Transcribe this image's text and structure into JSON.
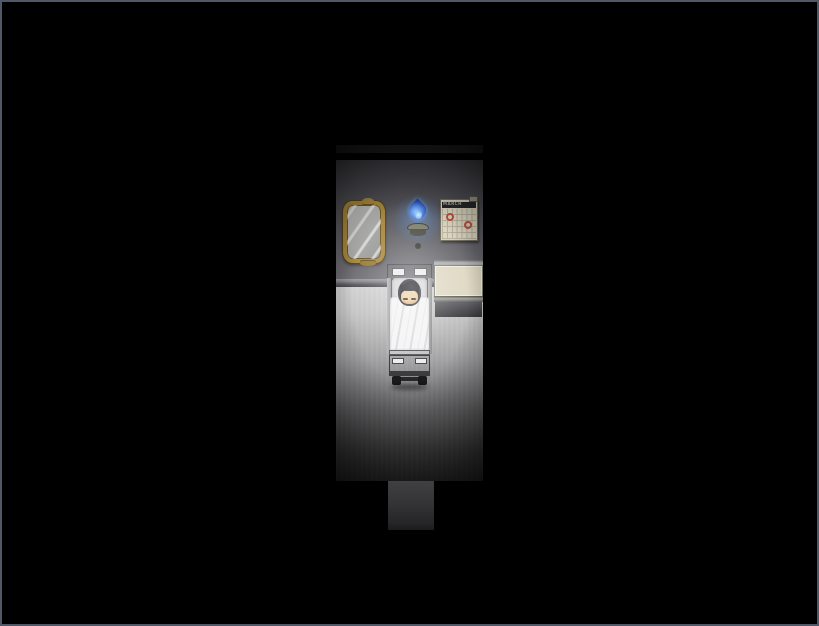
{
  "scene": {
    "name": "dark-bedroom-night",
    "description": "Top-down RPG room lit by a blue wall torch; a character sleeps in a wheeled bed",
    "visible_objects": [
      "ornate-mirror",
      "blue-torch-sconce",
      "wall-calendar",
      "side-table",
      "bed",
      "sleeping-character",
      "doorway-opening"
    ]
  },
  "window": {
    "frame_color": "#4e5866",
    "background_color": "#000000"
  },
  "room": {
    "wall_color": "#5f5f63",
    "floor_color": "#c6c6c6",
    "baseboard_color": "#9c9ca0",
    "doorway_color": "#343436"
  },
  "calendar": {
    "title": "MARCH",
    "columns": 7,
    "rows": 5,
    "marked_day_count": 2,
    "marker_color": "#b8402e",
    "body_color": "#d6d0ba",
    "header_color": "#26262a"
  },
  "mirror": {
    "frame_color": "#a8863c",
    "glass_color": "#b4b4b2"
  },
  "torch": {
    "flame_core_color": "#8cc0f4",
    "flame_color": "#3a66cc",
    "halo_color": "#6eaaff",
    "bracket_color": "#5c5c52"
  },
  "bed": {
    "blanket_color": "#f2f2f2",
    "frame_color": "#8e8e90",
    "headboard_panel_color": "#ececec",
    "wheel_color": "#1a1a1c"
  },
  "character": {
    "state": "sleeping",
    "eyes": "closed",
    "hair_color": "#17171a",
    "skin_color": "#eecfa0"
  },
  "side_table": {
    "top_color": "#ded8c2",
    "front_color": "#48484c"
  }
}
